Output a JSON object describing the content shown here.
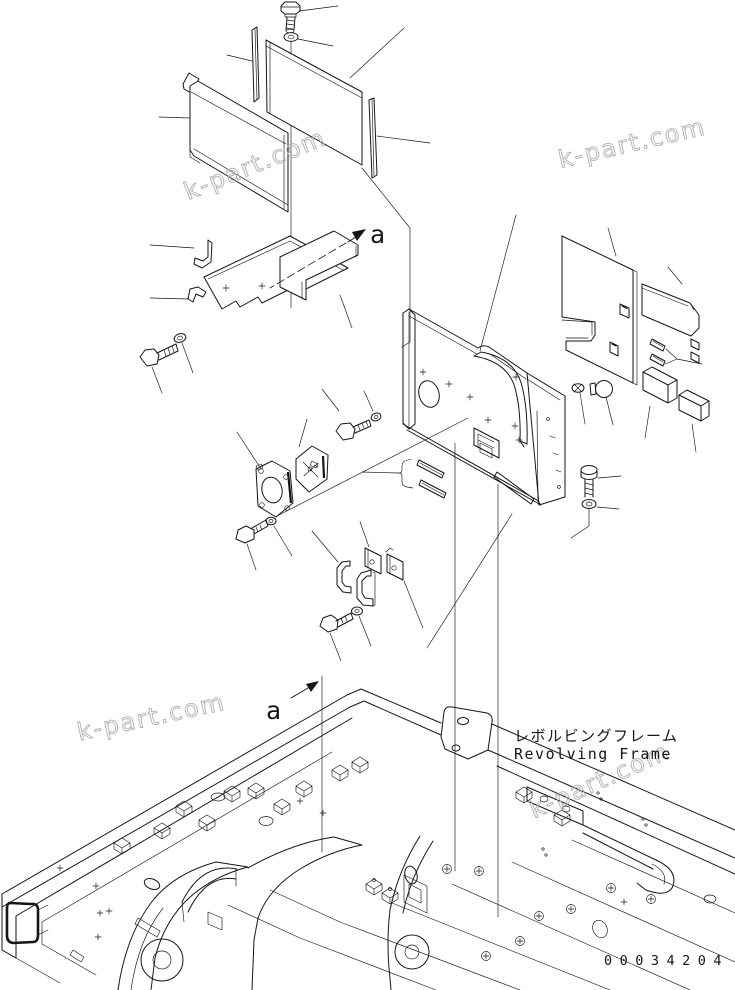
{
  "diagram": {
    "section_label": "a",
    "title_jp": "レボルビングフレーム",
    "title_en": "Revolving Frame",
    "part_number": "00034204",
    "watermark": "k-part.com",
    "colors": {
      "line": "#161616",
      "watermark": "#b0b0b0",
      "background": "#ffffff"
    }
  }
}
